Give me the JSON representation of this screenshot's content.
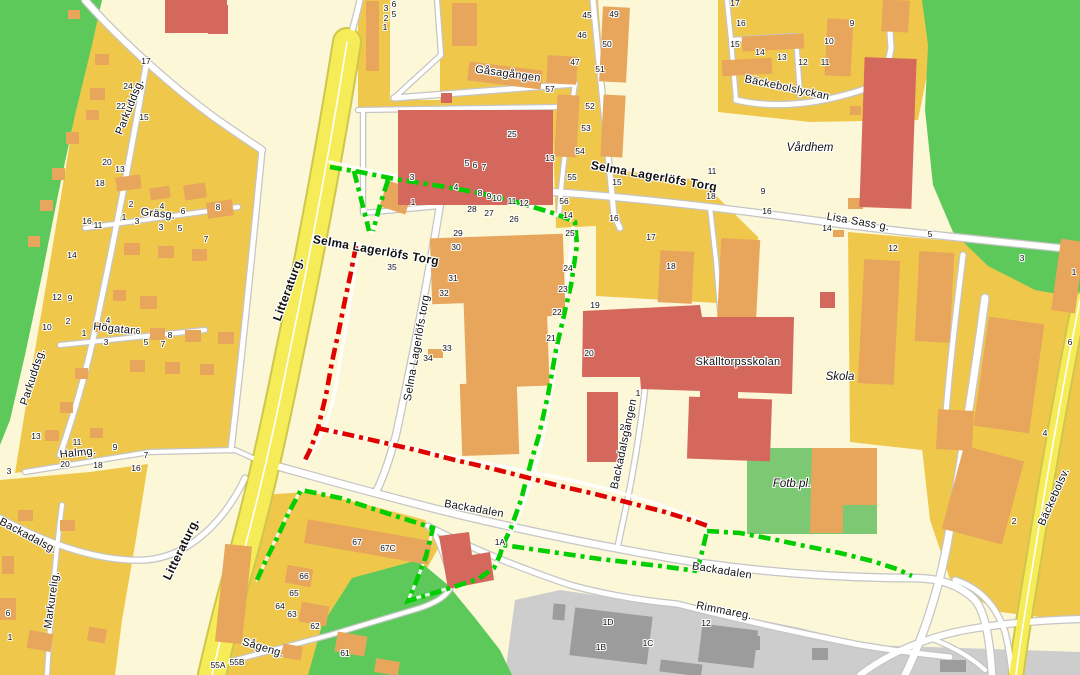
{
  "map": {
    "title": "Backa / Selma Lagerlöfs Torg map with marked routes",
    "colors": {
      "bg": "#FBF7D7",
      "residential": "#EFC84B",
      "bldgOrange": "#E7A65C",
      "bldgRed": "#D5685C",
      "parkGreen": "#5DC95A",
      "fieldGreen": "#7CC873",
      "industrial": "#CDCDCD",
      "bldgGray": "#9C9C9C",
      "roadWhite": "#FFFFFF",
      "roadCasing": "#C5C5C5",
      "mainRoadYellow": "#F5EC57",
      "mainRoadCasing": "#CFC64E",
      "routeGreen": "#00CE00",
      "routeRed": "#DF0000",
      "label": "#111111"
    },
    "street_labels": [
      {
        "t": "Parkuddsg.",
        "x": 130,
        "y": 107,
        "r": -68,
        "s": 11
      },
      {
        "t": "Parkuddsg.",
        "x": 33,
        "y": 377,
        "r": -72,
        "s": 11
      },
      {
        "t": "Gräsg.",
        "x": 158,
        "y": 214,
        "r": 6,
        "s": 11
      },
      {
        "t": "Högatan",
        "x": 115,
        "y": 329,
        "r": 6,
        "s": 11
      },
      {
        "t": "Halmg.",
        "x": 78,
        "y": 453,
        "r": -6,
        "s": 11
      },
      {
        "t": "Markurelig.",
        "x": 52,
        "y": 600,
        "r": -82,
        "s": 11
      },
      {
        "t": "Backadalsg.",
        "x": 28,
        "y": 536,
        "r": 28,
        "s": 11
      },
      {
        "t": "Litteraturg.",
        "x": 288,
        "y": 289,
        "r": -70,
        "s": 12,
        "bold": true
      },
      {
        "t": "Litteraturg.",
        "x": 181,
        "y": 549,
        "r": -64,
        "s": 12,
        "bold": true
      },
      {
        "t": "Selma Lagerlöfs Torg",
        "x": 376,
        "y": 250,
        "r": 10,
        "s": 12,
        "bold": true
      },
      {
        "t": "Selma Lagerlöfs torg",
        "x": 417,
        "y": 348,
        "r": -80,
        "s": 11
      },
      {
        "t": "Gåsagången",
        "x": 508,
        "y": 74,
        "r": 8,
        "s": 11
      },
      {
        "t": "Bäckebolslyckan",
        "x": 787,
        "y": 88,
        "r": 12,
        "s": 11
      },
      {
        "t": "Lisa Sass g.",
        "x": 858,
        "y": 222,
        "r": 10,
        "s": 11
      },
      {
        "t": "Selma Lagerlöfs Torg",
        "x": 654,
        "y": 176,
        "r": 10,
        "s": 12,
        "bold": true
      },
      {
        "t": "Skälltorpsskolan",
        "x": 738,
        "y": 362,
        "r": 0,
        "s": 11
      },
      {
        "t": "Backadalsgången",
        "x": 624,
        "y": 444,
        "r": -78,
        "s": 11
      },
      {
        "t": "Backadalen",
        "x": 474,
        "y": 509,
        "r": 10,
        "s": 11
      },
      {
        "t": "Backadalen",
        "x": 722,
        "y": 571,
        "r": 9,
        "s": 11
      },
      {
        "t": "Rimmareg.",
        "x": 724,
        "y": 611,
        "r": 11,
        "s": 11
      },
      {
        "t": "Bäckebolsv.",
        "x": 1054,
        "y": 497,
        "r": -66,
        "s": 11
      },
      {
        "t": "Sågeng.",
        "x": 263,
        "y": 648,
        "r": 17,
        "s": 11
      }
    ],
    "area_labels": [
      {
        "t": "Vårdhem",
        "x": 810,
        "y": 148
      },
      {
        "t": "Skola",
        "x": 840,
        "y": 377
      },
      {
        "t": "Fotb.pl.",
        "x": 792,
        "y": 484
      }
    ],
    "house_numbers": [
      [
        "17",
        146,
        61
      ],
      [
        "24",
        128,
        86
      ],
      [
        "22",
        121,
        106
      ],
      [
        "15",
        144,
        117
      ],
      [
        "20",
        107,
        162
      ],
      [
        "13",
        120,
        169
      ],
      [
        "18",
        100,
        183
      ],
      [
        "16",
        87,
        221
      ],
      [
        "2",
        131,
        204
      ],
      [
        "4",
        162,
        206
      ],
      [
        "6",
        183,
        211
      ],
      [
        "8",
        218,
        207
      ],
      [
        "1",
        124,
        217
      ],
      [
        "3",
        137,
        221
      ],
      [
        "14",
        72,
        255
      ],
      [
        "12",
        57,
        297
      ],
      [
        "9",
        70,
        298
      ],
      [
        "2",
        68,
        321
      ],
      [
        "10",
        47,
        327
      ],
      [
        "4",
        108,
        320
      ],
      [
        "1",
        84,
        333
      ],
      [
        "3",
        106,
        342
      ],
      [
        "5",
        146,
        342
      ],
      [
        "6",
        138,
        331
      ],
      [
        "8",
        170,
        335
      ],
      [
        "7",
        163,
        344
      ],
      [
        "11",
        98,
        225
      ],
      [
        "3",
        161,
        227
      ],
      [
        "5",
        180,
        228
      ],
      [
        "7",
        206,
        239
      ],
      [
        "13",
        36,
        436
      ],
      [
        "11",
        77,
        442
      ],
      [
        "9",
        115,
        447
      ],
      [
        "20",
        65,
        464
      ],
      [
        "18",
        98,
        465
      ],
      [
        "16",
        136,
        468
      ],
      [
        "7",
        146,
        455
      ],
      [
        "3",
        9,
        471
      ],
      [
        "6",
        8,
        613
      ],
      [
        "1",
        10,
        637
      ],
      [
        "6",
        394,
        4
      ],
      [
        "3",
        386,
        8
      ],
      [
        "5",
        394,
        14
      ],
      [
        "2",
        386,
        18
      ],
      [
        "1",
        385,
        27
      ],
      [
        "45",
        587,
        15
      ],
      [
        "46",
        582,
        35
      ],
      [
        "47",
        575,
        62
      ],
      [
        "57",
        550,
        89
      ],
      [
        "49",
        614,
        14
      ],
      [
        "50",
        607,
        44
      ],
      [
        "51",
        600,
        69
      ],
      [
        "52",
        590,
        106
      ],
      [
        "53",
        586,
        128
      ],
      [
        "54",
        580,
        151
      ],
      [
        "55",
        572,
        177
      ],
      [
        "56",
        564,
        201
      ],
      [
        "14",
        568,
        215
      ],
      [
        "25",
        570,
        233
      ],
      [
        "13",
        550,
        158
      ],
      [
        "25",
        512,
        134
      ],
      [
        "5",
        467,
        163
      ],
      [
        "6",
        475,
        165
      ],
      [
        "7",
        484,
        167
      ],
      [
        "8",
        480,
        193
      ],
      [
        "9",
        489,
        196
      ],
      [
        "10",
        497,
        198
      ],
      [
        "11",
        512,
        201
      ],
      [
        "12",
        524,
        203
      ],
      [
        "28",
        472,
        209
      ],
      [
        "27",
        489,
        213
      ],
      [
        "26",
        514,
        219
      ],
      [
        "3",
        412,
        177
      ],
      [
        "4",
        456,
        187
      ],
      [
        "1",
        413,
        202
      ],
      [
        "29",
        458,
        233
      ],
      [
        "30",
        456,
        247
      ],
      [
        "31",
        453,
        278
      ],
      [
        "32",
        444,
        293
      ],
      [
        "33",
        447,
        348
      ],
      [
        "34",
        428,
        358
      ],
      [
        "35",
        392,
        267
      ],
      [
        "15",
        617,
        182
      ],
      [
        "16",
        614,
        218
      ],
      [
        "17",
        651,
        237
      ],
      [
        "18",
        671,
        266
      ],
      [
        "19",
        595,
        305
      ],
      [
        "20",
        589,
        353
      ],
      [
        "21",
        551,
        338
      ],
      [
        "22",
        557,
        312
      ],
      [
        "23",
        563,
        289
      ],
      [
        "24",
        568,
        268
      ],
      [
        "11",
        712,
        171
      ],
      [
        "18",
        711,
        196
      ],
      [
        "9",
        763,
        191
      ],
      [
        "16",
        767,
        211
      ],
      [
        "14",
        827,
        228
      ],
      [
        "12",
        893,
        248
      ],
      [
        "5",
        930,
        234
      ],
      [
        "3",
        1022,
        258
      ],
      [
        "1",
        1074,
        272
      ],
      [
        "6",
        1070,
        342
      ],
      [
        "4",
        1045,
        433
      ],
      [
        "2",
        1014,
        521
      ],
      [
        "17",
        735,
        3
      ],
      [
        "16",
        741,
        23
      ],
      [
        "15",
        735,
        44
      ],
      [
        "14",
        760,
        52
      ],
      [
        "13",
        782,
        57
      ],
      [
        "12",
        803,
        62
      ],
      [
        "11",
        825,
        62
      ],
      [
        "9",
        852,
        23
      ],
      [
        "10",
        829,
        41
      ],
      [
        "1",
        638,
        393
      ],
      [
        "2",
        622,
        427
      ],
      [
        "1A",
        500,
        542
      ],
      [
        "67",
        357,
        542
      ],
      [
        "67C",
        388,
        548
      ],
      [
        "66",
        304,
        576
      ],
      [
        "65",
        294,
        593
      ],
      [
        "64",
        280,
        606
      ],
      [
        "63",
        292,
        614
      ],
      [
        "62",
        315,
        626
      ],
      [
        "61",
        345,
        653
      ],
      [
        "55A",
        218,
        665
      ],
      [
        "55B",
        237,
        662
      ],
      [
        "1D",
        608,
        622
      ],
      [
        "1B",
        601,
        647
      ],
      [
        "1C",
        648,
        643
      ],
      [
        "12",
        706,
        623
      ]
    ],
    "routes": [
      {
        "color": "green",
        "points": [
          [
            330,
            167
          ],
          [
            360,
            172
          ],
          [
            395,
            179
          ],
          [
            440,
            186
          ],
          [
            480,
            193
          ],
          [
            520,
            203
          ],
          [
            556,
            214
          ],
          [
            575,
            222
          ],
          [
            577,
            245
          ],
          [
            571,
            285
          ],
          [
            564,
            315
          ],
          [
            556,
            350
          ],
          [
            548,
            395
          ],
          [
            539,
            435
          ],
          [
            531,
            462
          ],
          [
            521,
            500
          ],
          [
            511,
            528
          ],
          [
            504,
            543
          ]
        ]
      },
      {
        "color": "green",
        "points": [
          [
            354,
            171
          ],
          [
            360,
            195
          ],
          [
            366,
            218
          ],
          [
            369,
            231
          ]
        ]
      },
      {
        "color": "green",
        "points": [
          [
            388,
            180
          ],
          [
            380,
            205
          ],
          [
            373,
            231
          ]
        ]
      },
      {
        "color": "green",
        "points": [
          [
            257,
            580
          ],
          [
            266,
            560
          ],
          [
            277,
            538
          ],
          [
            289,
            512
          ],
          [
            301,
            490
          ],
          [
            340,
            498
          ],
          [
            380,
            511
          ],
          [
            433,
            528
          ],
          [
            426,
            556
          ],
          [
            416,
            582
          ],
          [
            408,
            601
          ],
          [
            447,
            589
          ],
          [
            478,
            579
          ],
          [
            494,
            568
          ],
          [
            500,
            555
          ],
          [
            503,
            545
          ],
          [
            545,
            551
          ],
          [
            600,
            559
          ],
          [
            660,
            566
          ],
          [
            697,
            571
          ]
        ]
      },
      {
        "color": "green",
        "points": [
          [
            697,
            571
          ],
          [
            702,
            552
          ],
          [
            707,
            531
          ]
        ]
      },
      {
        "color": "green",
        "points": [
          [
            707,
            531
          ],
          [
            740,
            533
          ],
          [
            772,
            539
          ],
          [
            805,
            546
          ],
          [
            840,
            553
          ],
          [
            872,
            561
          ],
          [
            897,
            569
          ],
          [
            912,
            576
          ]
        ]
      },
      {
        "color": "red",
        "points": [
          [
            356,
            246
          ],
          [
            351,
            272
          ],
          [
            345,
            300
          ],
          [
            339,
            330
          ],
          [
            332,
            362
          ],
          [
            326,
            395
          ],
          [
            318,
            428
          ],
          [
            311,
            448
          ],
          [
            304,
            462
          ]
        ]
      },
      {
        "color": "red",
        "points": [
          [
            317,
            428
          ],
          [
            350,
            435
          ],
          [
            385,
            443
          ],
          [
            420,
            451
          ],
          [
            455,
            460
          ],
          [
            490,
            468
          ],
          [
            525,
            477
          ],
          [
            560,
            486
          ],
          [
            595,
            494
          ],
          [
            630,
            503
          ],
          [
            665,
            512
          ],
          [
            694,
            521
          ],
          [
            708,
            526
          ]
        ]
      }
    ]
  }
}
